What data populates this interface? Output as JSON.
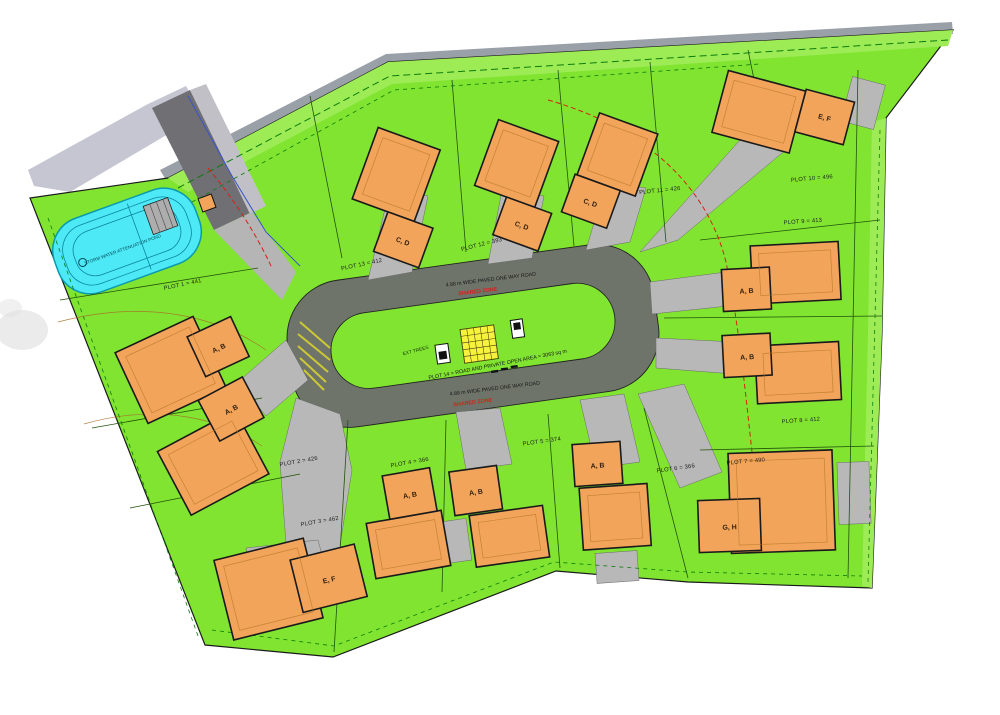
{
  "plan": {
    "pond_label": "STORM WATER ATTENUATION POND",
    "upper_road": {
      "label": "4.88 m WIDE PAVED ONE WAY ROAD",
      "shared_zone": "SHARED ZONE"
    },
    "lower_road": {
      "label": "4.88 m WIDE PAVED ONE WAY ROAD",
      "shared_zone": "SHARED ZONE"
    },
    "ext_trees_label": "EXT TREES",
    "open_area_label": "PLOT 14 = ROAD AND PRIVATE OPEN AREA = 3063 sq m",
    "plots": [
      {
        "id": "plot-1",
        "label": "PLOT 1 = 441"
      },
      {
        "id": "plot-2",
        "label": "PLOT 2 = 426"
      },
      {
        "id": "plot-3",
        "label": "PLOT 3 = 462"
      },
      {
        "id": "plot-4",
        "label": "PLOT 4 = 366"
      },
      {
        "id": "plot-5",
        "label": "PLOT 5 = 374"
      },
      {
        "id": "plot-6",
        "label": "PLOT 6 = 366"
      },
      {
        "id": "plot-7",
        "label": "PLOT 7 = 490"
      },
      {
        "id": "plot-8",
        "label": "PLOT 8 = 412"
      },
      {
        "id": "plot-9",
        "label": "PLOT 9 = 413"
      },
      {
        "id": "plot-10",
        "label": "PLOT 10 = 496"
      },
      {
        "id": "plot-11",
        "label": "PLOT 11 = 426"
      },
      {
        "id": "plot-12",
        "label": "PLOT 12 = 393"
      },
      {
        "id": "plot-13",
        "label": "PLOT 13 = 412"
      }
    ],
    "houses": [
      {
        "id": "plot-1-house",
        "label": "A, B"
      },
      {
        "id": "plot-2-house",
        "label": "A, B"
      },
      {
        "id": "top-house-1",
        "label": "C, D"
      },
      {
        "id": "top-house-2",
        "label": "C, D"
      },
      {
        "id": "top-house-3",
        "label": "C, D"
      },
      {
        "id": "top-right-house",
        "label": "E, F"
      },
      {
        "id": "right-upper-house",
        "label": "A, B"
      },
      {
        "id": "right-lower-house",
        "label": "A, B"
      },
      {
        "id": "bottom-right-house",
        "label": "G, H"
      },
      {
        "id": "bottom-house-3",
        "label": "A, B"
      },
      {
        "id": "bottom-house-2",
        "label": "A, B"
      },
      {
        "id": "bottom-house-1",
        "label": "A, B"
      },
      {
        "id": "bottom-left-house",
        "label": "E, F"
      }
    ],
    "colors": {
      "site_green": "#80E431",
      "verge_green": "#9DEC55",
      "road_dark": "#6E746A",
      "driveway_grey": "#B8B8B8",
      "offsite_road_grey": "#C6C6D2",
      "house_orange": "#F2A45A",
      "outline_black": "#1A1A1A",
      "pond_cyan": "#4DE9F7",
      "pond_edge_teal": "#0A9AAD",
      "marker_yellow": "#F7F23C",
      "shared_zone_red": "#D42313",
      "services_dash_green": "#0C7C0C",
      "plot_boundary_green": "#23520B"
    }
  }
}
